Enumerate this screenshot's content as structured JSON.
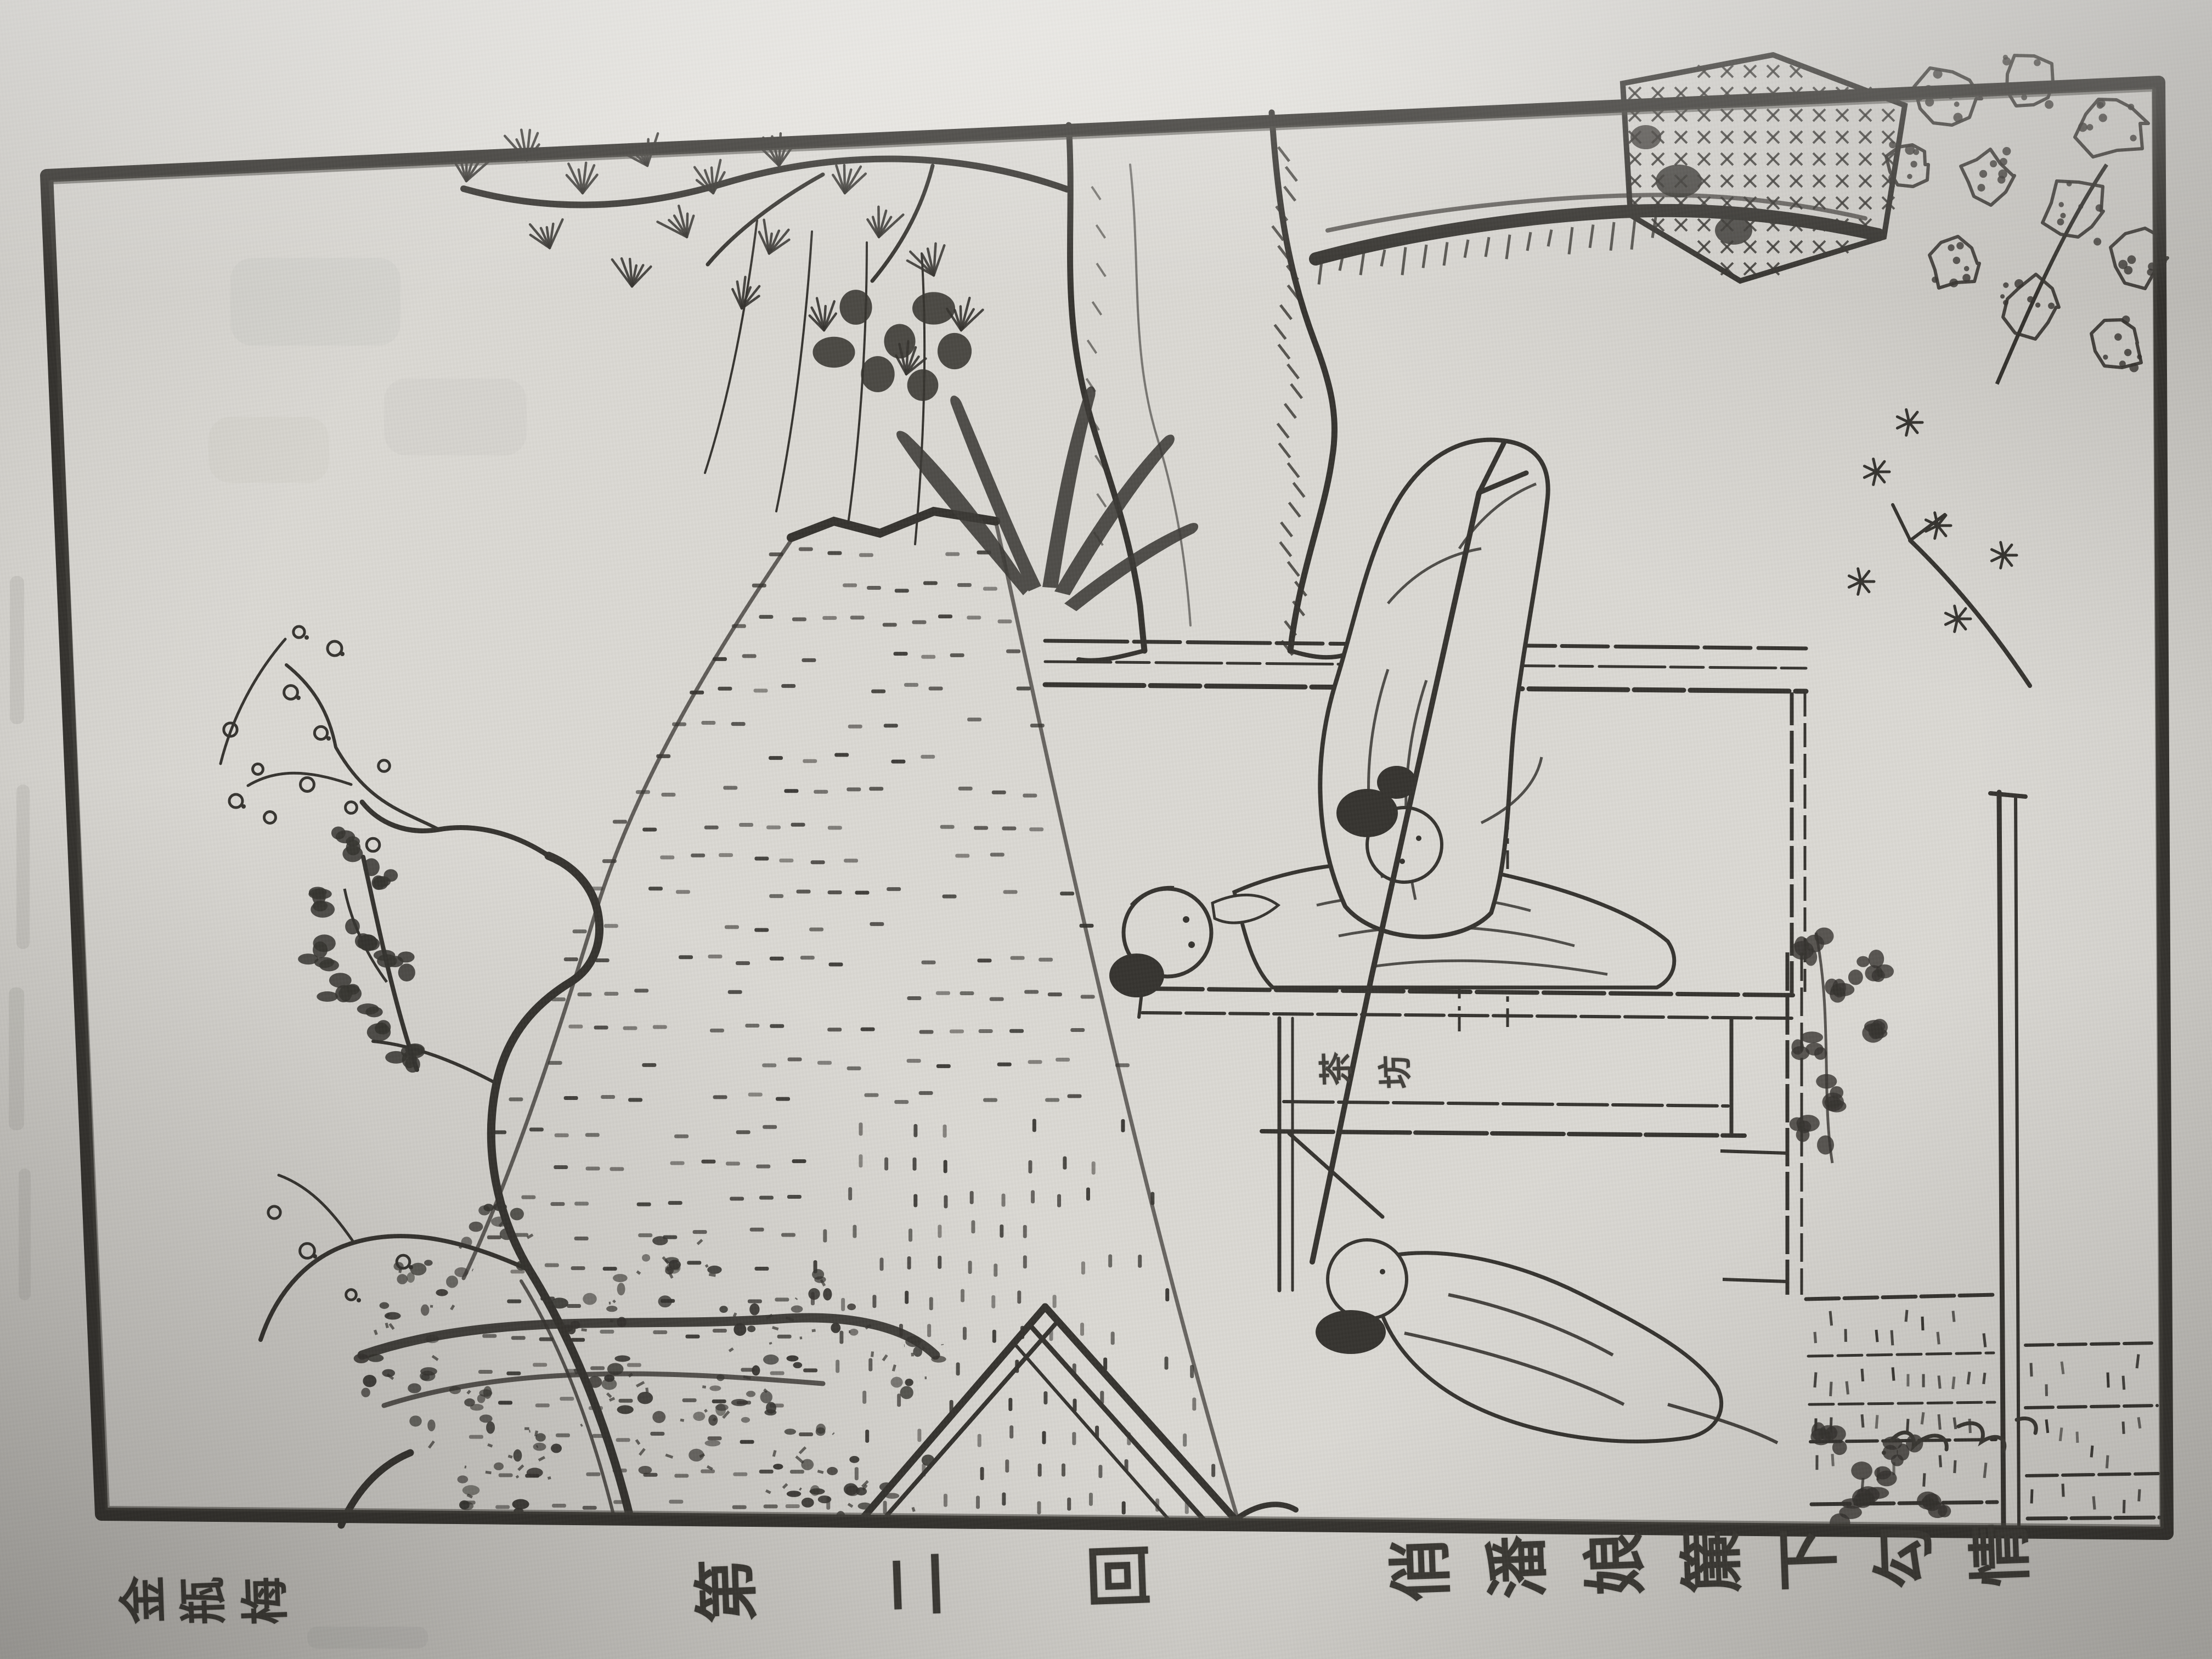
{
  "artwork": {
    "kind": "woodblock-print-book-page-photo",
    "colors": {
      "ink": "#34322e",
      "ink_light": "#4a4844",
      "paper_inside_frame": "#d9d7d2",
      "paper_outside": "#e2e0db",
      "paper_shadow": "#bfbdb8"
    }
  },
  "captions": {
    "book_title": {
      "text": "金瓶梅",
      "chars": [
        "金",
        "瓶",
        "梅"
      ]
    },
    "chapter_number": {
      "text": "第二回",
      "chars": [
        "第",
        "二",
        "回"
      ]
    },
    "chapter_title": {
      "text": "俏潘娘簾下勾情",
      "chars": [
        "俏",
        "潘",
        "娘",
        "簾",
        "下",
        "勾",
        "情"
      ]
    },
    "shop_sign": {
      "text": "茶坊",
      "chars": [
        "茶",
        "坊"
      ]
    }
  }
}
